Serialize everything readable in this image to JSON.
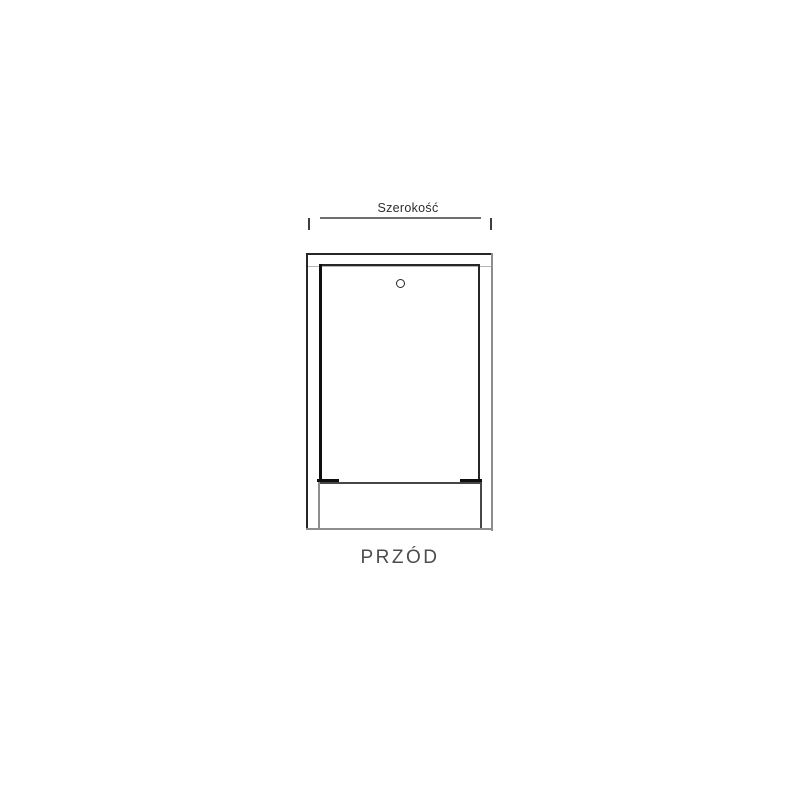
{
  "drawing": {
    "dimension_label": "Szerokość",
    "view_label": "PRZÓD"
  },
  "icons": {
    "lock_hole": "small circle (door lock / screw hole) near top center of door"
  },
  "colors": {
    "background": "#ffffff",
    "line_dark": "#262626",
    "line_black": "#0f0f0f",
    "line_medium": "#474747",
    "line_gray": "#8d8d8d",
    "line_light": "#b5b5b5",
    "dim_line": "#6e6e6e",
    "dim_tick": "#3d3d3d",
    "dimension_text": "#2d2d2d",
    "caption_text": "#4c4c4c"
  }
}
